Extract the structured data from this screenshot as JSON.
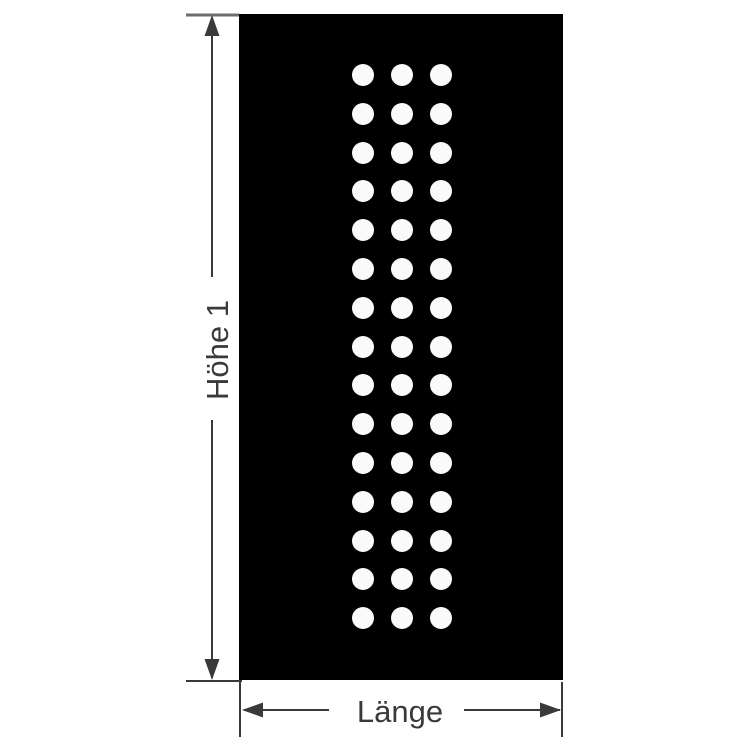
{
  "figure": {
    "type": "dimension-drawing",
    "labels": {
      "height_label": "Höhe 1",
      "length_label": "Länge"
    },
    "colors": {
      "background": "#ffffff",
      "plate": "#000000",
      "hole": "#fafafa",
      "dimension_line": "#3a3a3a",
      "extension_line": "#3a3a3a",
      "extension_line_top": "#6e6e6e",
      "label_text": "#3a3a3a"
    },
    "plate": {
      "x": 239,
      "y": 14,
      "width": 324,
      "height": 666
    },
    "hole_grid": {
      "columns": 3,
      "rows": 15,
      "hole_count": 45,
      "first_center_x": 363,
      "first_center_y": 75,
      "column_spacing": 39,
      "row_spacing": 38.8,
      "hole_radius": 11
    }
  }
}
